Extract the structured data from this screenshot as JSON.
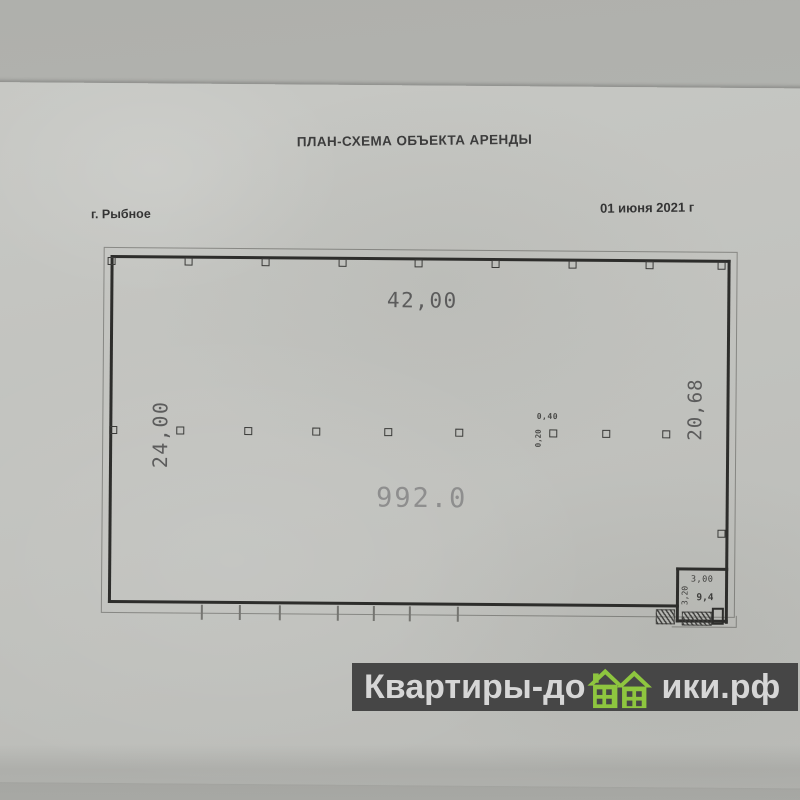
{
  "document": {
    "title": "ПЛАН-СХЕМА ОБЪЕКТА АРЕНДЫ",
    "city_label": "г. Рыбное",
    "date_label": "01 июня 2021 г"
  },
  "plan": {
    "top_width": "42,00",
    "left_depth": "24,00",
    "right_depth": "20,68",
    "area": "992.0",
    "column_width": "0,40",
    "column_depth": "0,20",
    "annex": {
      "width": "3,00",
      "depth": "3,20",
      "area": "9,4"
    }
  },
  "watermark": {
    "text_before_houses": "Квартиры-до",
    "text_after_houses": "ики.рф",
    "full_text": "Квартиры-домики.рф"
  },
  "colors": {
    "paper": "#c2c3bf",
    "ink": "#2d2d2b",
    "dimension_text": "#5c5c5c",
    "area_text": "#8e8e8e",
    "watermark_bar": "#464646",
    "watermark_text": "#d6d6d6",
    "watermark_green": "#8ec63f"
  }
}
